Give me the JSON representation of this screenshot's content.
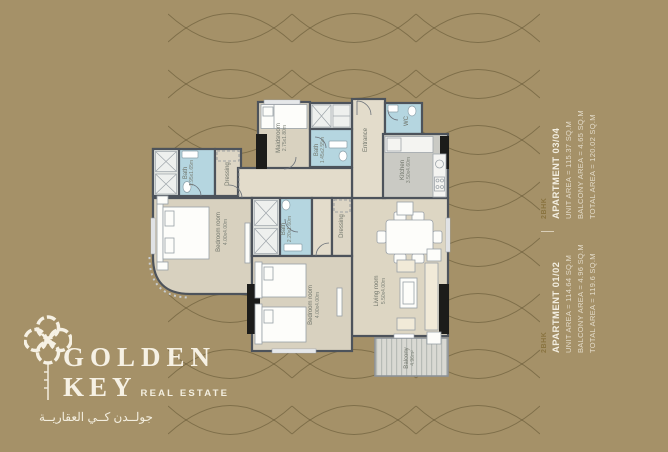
{
  "background": {
    "color": "#a59168"
  },
  "logo": {
    "title_line1": "GOLDEN",
    "title_line2": "KEY",
    "subtitle": "REAL ESTATE",
    "arabic": "جولــدن كــي العقاريــة"
  },
  "info_panel": {
    "apartments": [
      {
        "type": "2BHK",
        "title": "APARTMENT 01/02",
        "unit_area": "UNIT AREA = 114.64 SQ.M",
        "balcony_area": "BALCONY AREA = 4.96 SQ.M",
        "total_area": "TOTAL AREA = 119.6 SQ.M"
      },
      {
        "type": "2BHK",
        "title": "APARTMENT 03/04",
        "unit_area": "UNIT AREA = 115.37 SQ.M",
        "balcony_area": "BALCONY AREA = 4.65 SQ.M",
        "total_area": "TOTAL AREA = 120.02 SQ.M"
      }
    ]
  },
  "plan": {
    "rooms": {
      "maidsroom": {
        "name": "Maidsroom",
        "dims": "2.75x1.80m"
      },
      "maid_bath": {
        "name": "Bath",
        "dims": "1.45x2.55m"
      },
      "entrance": {
        "name": "Entrance"
      },
      "wc": {
        "name": "WC"
      },
      "kitchen": {
        "name": "Kitchen",
        "dims": "3.50x4.60m"
      },
      "bath_master": {
        "name": "Bath",
        "dims": "1.95x1.65m"
      },
      "dressing_master": {
        "name": "Dressing"
      },
      "bedroom_master": {
        "name": "Bedroom room",
        "dims": "4.00x4.00m"
      },
      "bath_shared": {
        "name": "Bath",
        "dims": "2.20x1.60m"
      },
      "dressing_second": {
        "name": "Dressing"
      },
      "bedroom_second": {
        "name": "Bedroom room",
        "dims": "4.00x4.00m"
      },
      "living": {
        "name": "Living room",
        "dims": "5.50x4.00m"
      },
      "balcony": {
        "name": "Balcony",
        "dims": "4.96m²"
      }
    }
  }
}
